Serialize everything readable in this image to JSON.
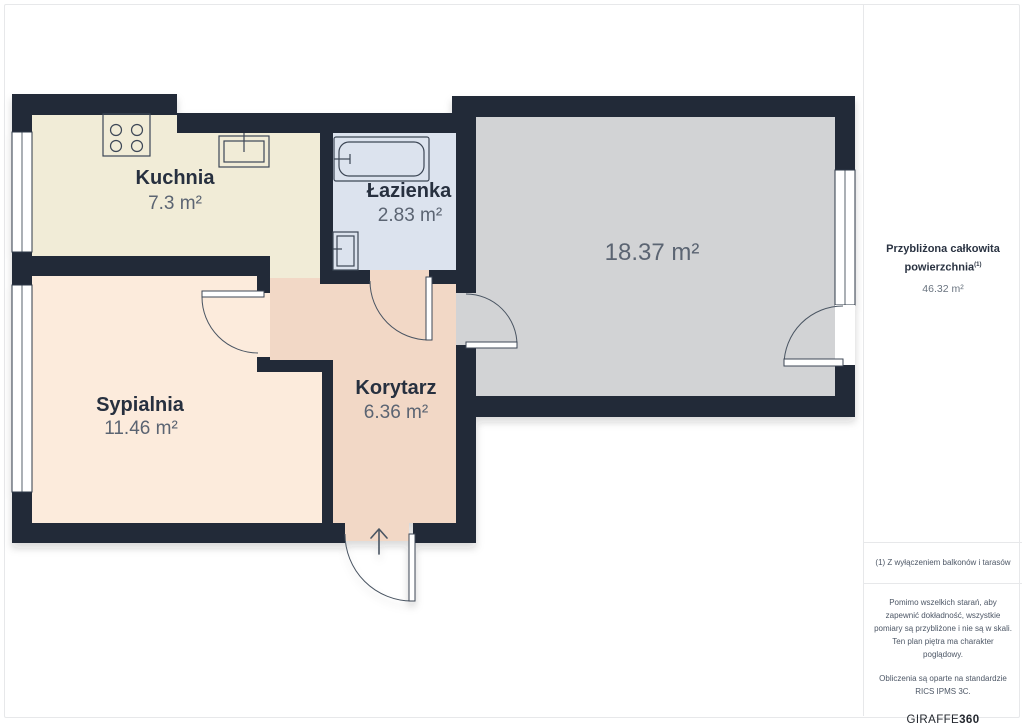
{
  "page": {
    "background": "#ffffff",
    "card_border_color": "#e7e8ea"
  },
  "floorplan": {
    "wall_color": "#202b39",
    "window_color": "#ffffff",
    "fixture_stroke": "#3d4756",
    "room_name_color": "#27303f",
    "room_area_color": "#5b6472",
    "rooms": [
      {
        "id": "kuchnia",
        "name": "Kuchnia",
        "area": "7.3 m²",
        "color": "#f1ecd7"
      },
      {
        "id": "lazienka",
        "name": "Łazienka",
        "area": "2.83 m²",
        "color": "#dce3ee"
      },
      {
        "id": "sypialnia",
        "name": "Sypialnia",
        "area": "11.46 m²",
        "color": "#fcebdc"
      },
      {
        "id": "korytarz",
        "name": "Korytarz",
        "area": "6.36 m²",
        "color": "#f2d8c6"
      },
      {
        "id": "pokoj",
        "name": "",
        "area": "18.37 m²",
        "color": "#d2d3d5"
      }
    ]
  },
  "sidebar": {
    "title_line1": "Przybliżona całkowita",
    "title_line2": "powierzchnia",
    "title_sup": "(1)",
    "total_area": "46.32 m²",
    "footnote": "(1) Z wyłączeniem balkonów i tarasów",
    "disclaimer1_lines": [
      "Pomimo wszelkich starań, aby",
      "zapewnić dokładność, wszystkie",
      "pomiary są przybliżone i nie są w skali.",
      "Ten plan piętra ma charakter",
      "poglądowy."
    ],
    "disclaimer2_lines": [
      "Obliczenia są oparte na standardzie",
      "RICS IPMS 3C."
    ],
    "logo_text": "GIRAFFE",
    "logo_bold": "360"
  }
}
